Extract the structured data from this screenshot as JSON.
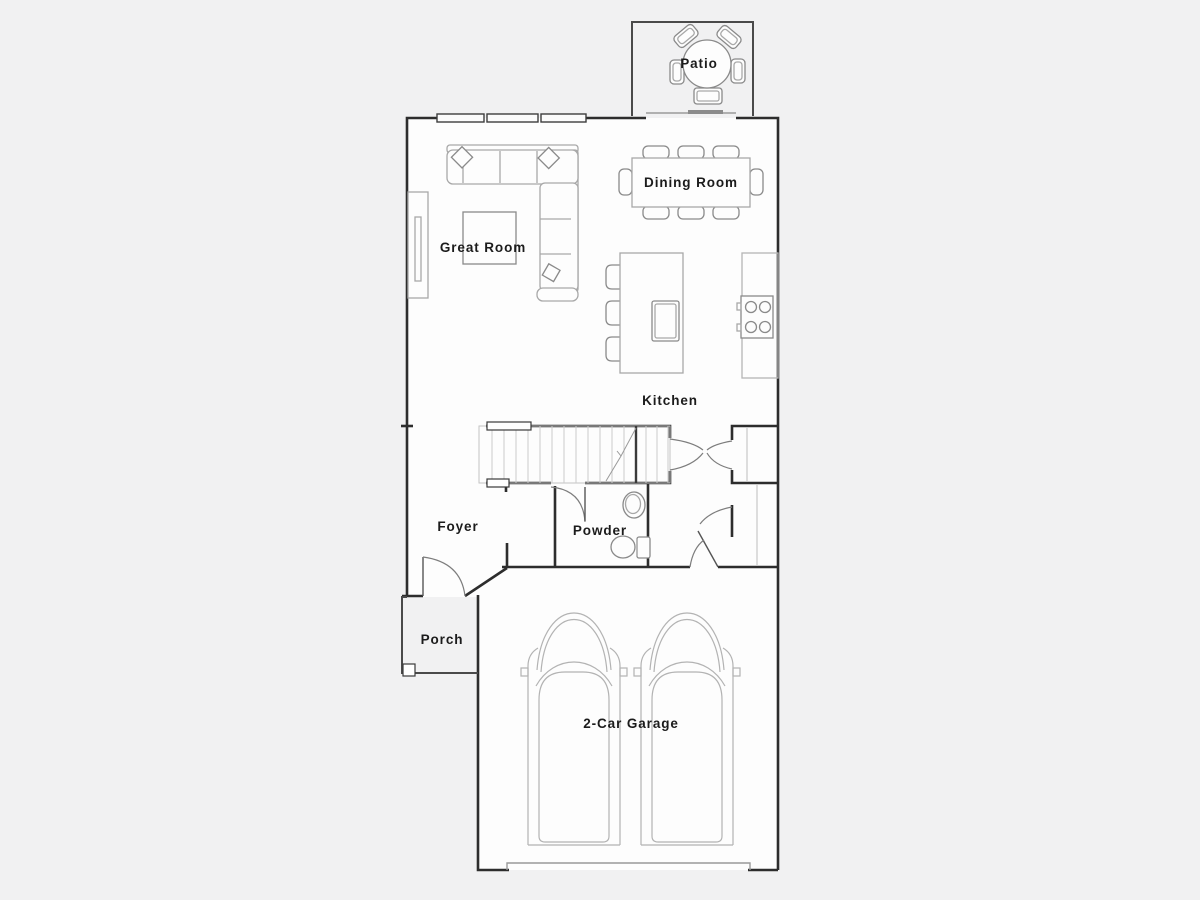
{
  "floorplan": {
    "rooms": {
      "patio": "Patio",
      "dining_room": "Dining Room",
      "great_room": "Great Room",
      "kitchen": "Kitchen",
      "foyer": "Foyer",
      "powder": "Powder",
      "porch": "Porch",
      "garage": "2-Car Garage"
    },
    "colors": {
      "background": "#f1f1f2",
      "floor": "#fdfdfd",
      "wall": "#2d2d2d",
      "furniture": "#a8a8a8",
      "accent": "#7d7d7d",
      "label": "#1c1c1c"
    }
  }
}
